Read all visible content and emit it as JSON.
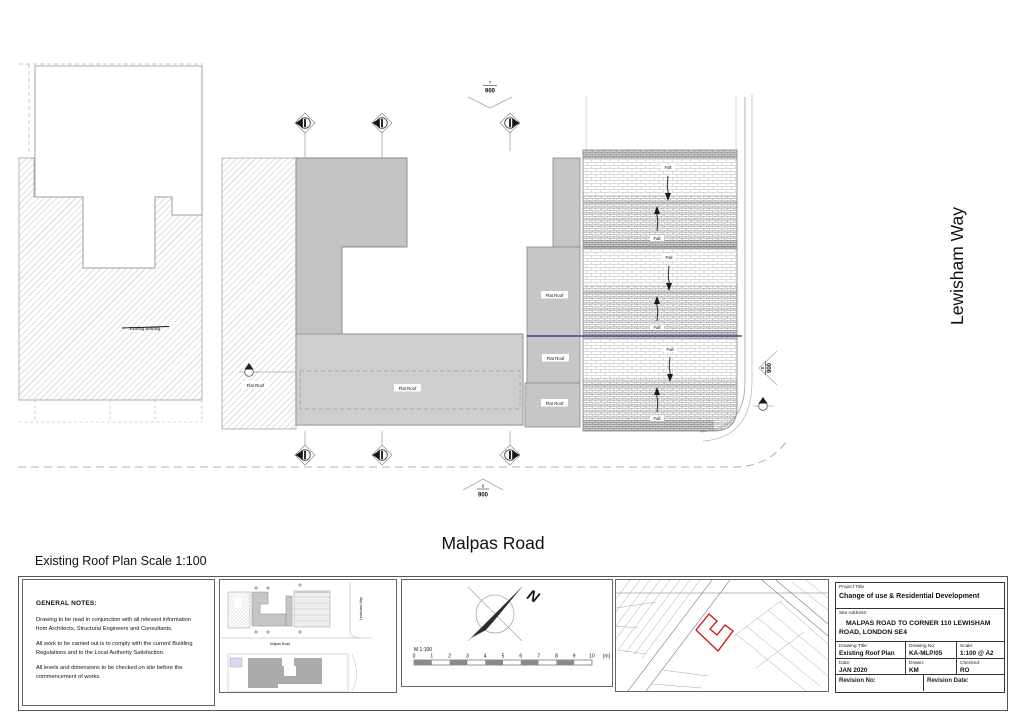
{
  "plan": {
    "caption": "Existing Roof Plan Scale 1:100",
    "road_label": "Malpas Road",
    "side_road_label": "Lewisham Way",
    "flat_roof_label": "Flat Roof",
    "fall_label": "Fall",
    "adjacent_building_label": "Existing Building",
    "ref_markers": {
      "top_number": "7",
      "top_sheet": "900",
      "bottom_number": "6",
      "bottom_sheet": "900",
      "right_number": "8",
      "right_sheet": "900"
    }
  },
  "footer": {
    "notes": {
      "title": "GENERAL NOTES:",
      "paragraphs": [
        "Drawing to be read in conjunction with all relevant information from Architects, Structural Engineers and Consultants.",
        "All work to be carried out is to comply with the current Building Regulations and to the Local Authority Satisfaction.",
        "All levels and dimensions to be checked on site before the commencement of works."
      ]
    },
    "key_plan": {
      "road_label": "Malpas Road",
      "side_road_label": "Lewisham Way"
    },
    "north_label": "N",
    "scale_bar": {
      "label": "M 1:100",
      "ticks": [
        "0",
        "1",
        "2",
        "3",
        "4",
        "5",
        "6",
        "7",
        "8",
        "9",
        "10"
      ],
      "unit": "[m]"
    },
    "title_block": {
      "project_title_label": "Project Title",
      "project_title": "Change of use & Residential Development",
      "site_address_label": "Site Address:",
      "site_address": "MALPAS ROAD TO CORNER 110 LEWISHAM ROAD, LONDON SE4",
      "drawing_title_label": "Drawing Title:",
      "drawing_title": "Existing Roof Plan",
      "drawing_no_label": "Drawing No:",
      "drawing_no": "KA-MLP/05",
      "scale_label": "Scale:",
      "scale": "1:100 @ A2",
      "date_label": "Date:",
      "date": "JAN 2020",
      "drawn_label": "Drawn:",
      "drawn": "KM",
      "checked_label": "Checked:",
      "checked": "RO",
      "revision_no_label": "Revision No:",
      "revision_date_label": "Revision Date:"
    }
  },
  "colors": {
    "building_gray": "#c6c6c6",
    "boundary_blue": "#2b2b85",
    "site_outline_red": "#cc1111"
  }
}
